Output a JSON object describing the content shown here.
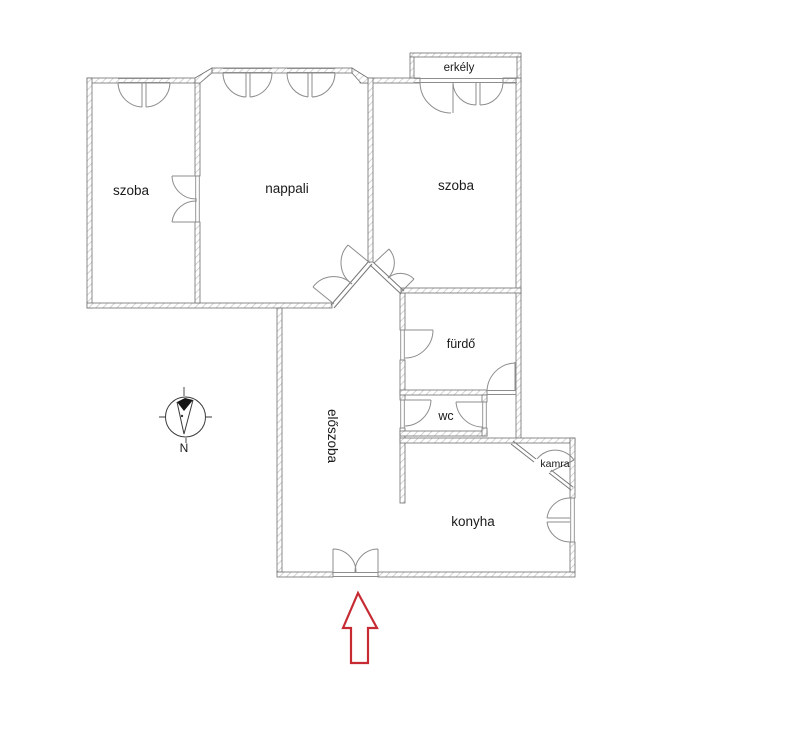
{
  "rooms": [
    {
      "id": "szoba-left",
      "label": "szoba"
    },
    {
      "id": "nappali",
      "label": "nappali"
    },
    {
      "id": "szoba-right",
      "label": "szoba"
    },
    {
      "id": "erkely",
      "label": "erkély"
    },
    {
      "id": "furdo",
      "label": "fürdő"
    },
    {
      "id": "wc",
      "label": "wc"
    },
    {
      "id": "eloszoba",
      "label": "előszoba"
    },
    {
      "id": "konyha",
      "label": "konyha"
    },
    {
      "id": "kamra",
      "label": "kamra"
    }
  ],
  "compass": {
    "north_label": "N"
  },
  "colors": {
    "background": "#ffffff",
    "wall_outline": "#6f6f6f",
    "wall_hatch": "#c2c2c2",
    "door_arc": "#8d8d8d",
    "diagonal_frame": "#777777",
    "text": "#1a1a1a",
    "compass_stroke": "#3a3a3a",
    "entrance_arrow": "#c62a33"
  }
}
